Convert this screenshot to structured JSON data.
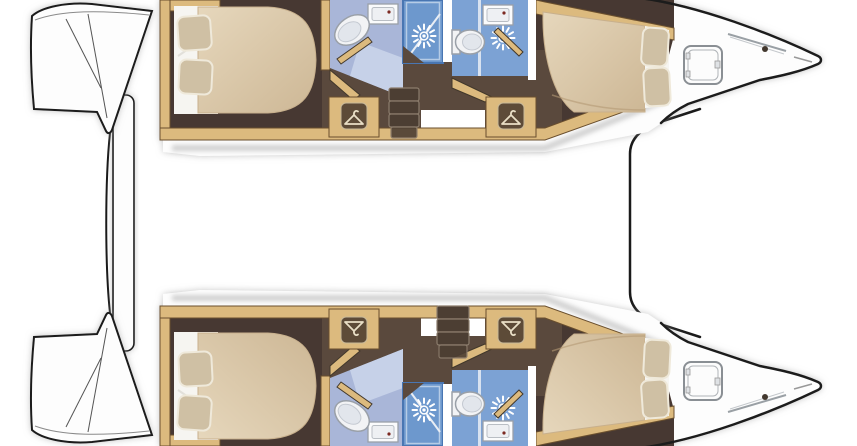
{
  "canvas": {
    "width": 857,
    "height": 446
  },
  "title": "catamaran-lower-deck-floorplan",
  "colors": {
    "deck": "#fdfdfd",
    "outline": "#1a1a1a",
    "wood": "#dcba7e",
    "woodBorder": "#6a4f2e",
    "floorDark": "#463831",
    "floorMid": "#5a493c",
    "sheet": "#f6f5f1",
    "pillow": "#cfc0a4",
    "mattressLight": "#e3d3b8",
    "mattressDark": "#cdb795",
    "bathLight": "#a9b6d8",
    "bathLighter": "#c6d1e8",
    "bathMed": "#7ba2d4",
    "showerBlue": "#6d98cd",
    "showerBorder": "#4976b2",
    "fixtureWhite": "#f2f3f5",
    "fixtureStroke": "#9aa0a8",
    "faucetDot": "#7c2a20",
    "shadow": "#9a9a9a"
  },
  "floorplan": {
    "type": "catamaran-lower-deck",
    "orientation": {
      "sterns": "left",
      "bows": "right"
    },
    "shared_features": [
      "stern-transom-steps",
      "aft-crossbeam-platform",
      "bow-trampoline"
    ],
    "hulls": [
      {
        "name": "port-hull",
        "rooms": [
          "aft-double-cabin",
          "aft-bathroom",
          "aft-shower-stall",
          "companionway-steps",
          "forward-bathroom",
          "forward-shower-stall",
          "forward-double-cabin",
          "foredeck"
        ],
        "fixtures": {
          "double-berths": 2,
          "pillows": 4,
          "toilets": 2,
          "sinks": 2,
          "shower-sprays": 2,
          "wardrobes": 2,
          "deck-hatches": 1,
          "step-treads": 4
        }
      },
      {
        "name": "starboard-hull",
        "rooms": [
          "aft-double-cabin",
          "aft-bathroom",
          "aft-shower-stall",
          "companionway-steps",
          "forward-bathroom",
          "forward-shower-stall",
          "forward-double-cabin",
          "foredeck"
        ],
        "fixtures": {
          "double-berths": 2,
          "pillows": 4,
          "toilets": 2,
          "sinks": 2,
          "shower-sprays": 2,
          "wardrobes": 2,
          "deck-hatches": 1,
          "step-treads": 4
        }
      }
    ],
    "icons": [
      "hanger-icon",
      "shower-spray-icon",
      "toilet-icon",
      "sink-icon",
      "deck-hatch-icon"
    ]
  }
}
